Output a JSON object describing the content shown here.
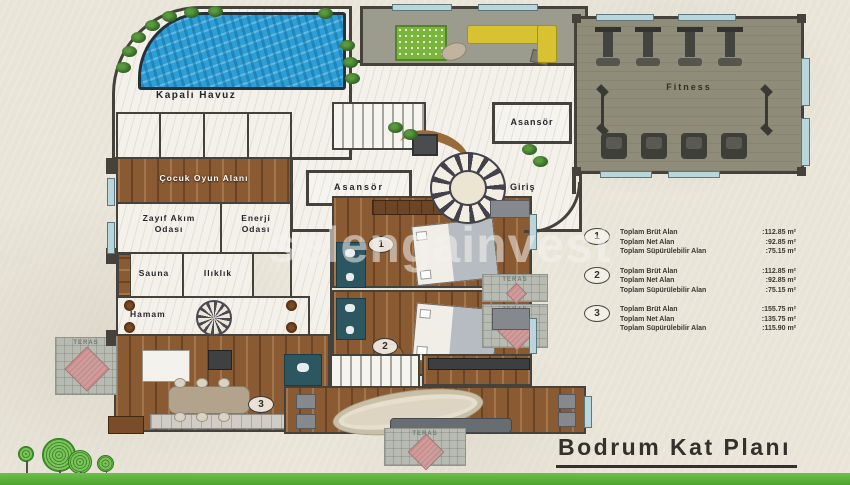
{
  "page_title": "Bodrum Kat Planı",
  "watermark": "selengainvest",
  "labels": {
    "pool": "Kapalı Havuz",
    "play_area": "Çocuk Oyun Alanı",
    "low_current_1": "Zayıf Akım",
    "low_current_2": "Odası",
    "energy_1": "Enerji",
    "energy_2": "Odası",
    "sauna": "Sauna",
    "warm_room": "Ilıklık",
    "hamam": "Hamam",
    "elevator": "Asansör",
    "entrance": "Giriş",
    "fitness": "Fitness",
    "terrace": "TERAS"
  },
  "unit_badges": [
    "1",
    "2",
    "3"
  ],
  "legend": {
    "items": [
      {
        "number": "1",
        "rows": [
          {
            "label": "Toplam Brüt Alan",
            "value": ":112.85 m²"
          },
          {
            "label": "Toplam Net Alan",
            "value": ":92.85 m²"
          },
          {
            "label": "Toplam Süpürülebilir Alan",
            "value": ":75.15 m²"
          }
        ]
      },
      {
        "number": "2",
        "rows": [
          {
            "label": "Toplam Brüt Alan",
            "value": ":112.85 m²"
          },
          {
            "label": "Toplam Net Alan",
            "value": ":92.85 m²"
          },
          {
            "label": "Toplam Süpürülebilir Alan",
            "value": ":75.15 m²"
          }
        ]
      },
      {
        "number": "3",
        "rows": [
          {
            "label": "Toplam Brüt Alan",
            "value": ":155.75 m²"
          },
          {
            "label": "Toplam Net Alan",
            "value": ":135.75 m²"
          },
          {
            "label": "Toplam Süpürülebilir Alan",
            "value": ":115.90 m²"
          }
        ]
      }
    ]
  },
  "colors": {
    "pool_water": "#2d9fd6",
    "wood_floor": "#8a5a33",
    "fitness_floor": "#8f8d79",
    "lounge_floor": "#9c9c8e",
    "terrace_hatch": "#d4898c",
    "bathroom": "#2c5660",
    "sofa_yellow": "#d7c331",
    "green_stripe": "#5fb73f",
    "wall": "#45423c",
    "paper": "#e8e4d8"
  }
}
